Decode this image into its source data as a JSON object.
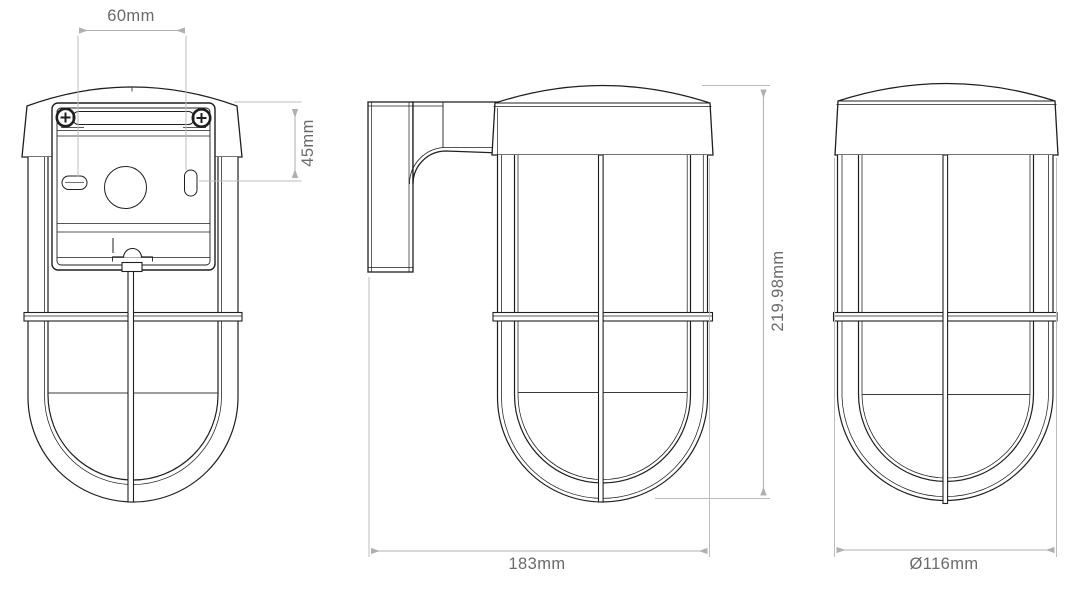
{
  "drawing": {
    "labels": {
      "hole_spacing": "60mm",
      "hole_vertical_offset": "45mm",
      "overall_height": "219.98mm",
      "overall_depth": "183mm",
      "diameter": "Ø116mm"
    },
    "colors": {
      "linework": "#1f1f1f",
      "dimension_lines": "#b6b6b6",
      "dimension_text": "#6a6a6a",
      "background": "#ffffff"
    }
  }
}
